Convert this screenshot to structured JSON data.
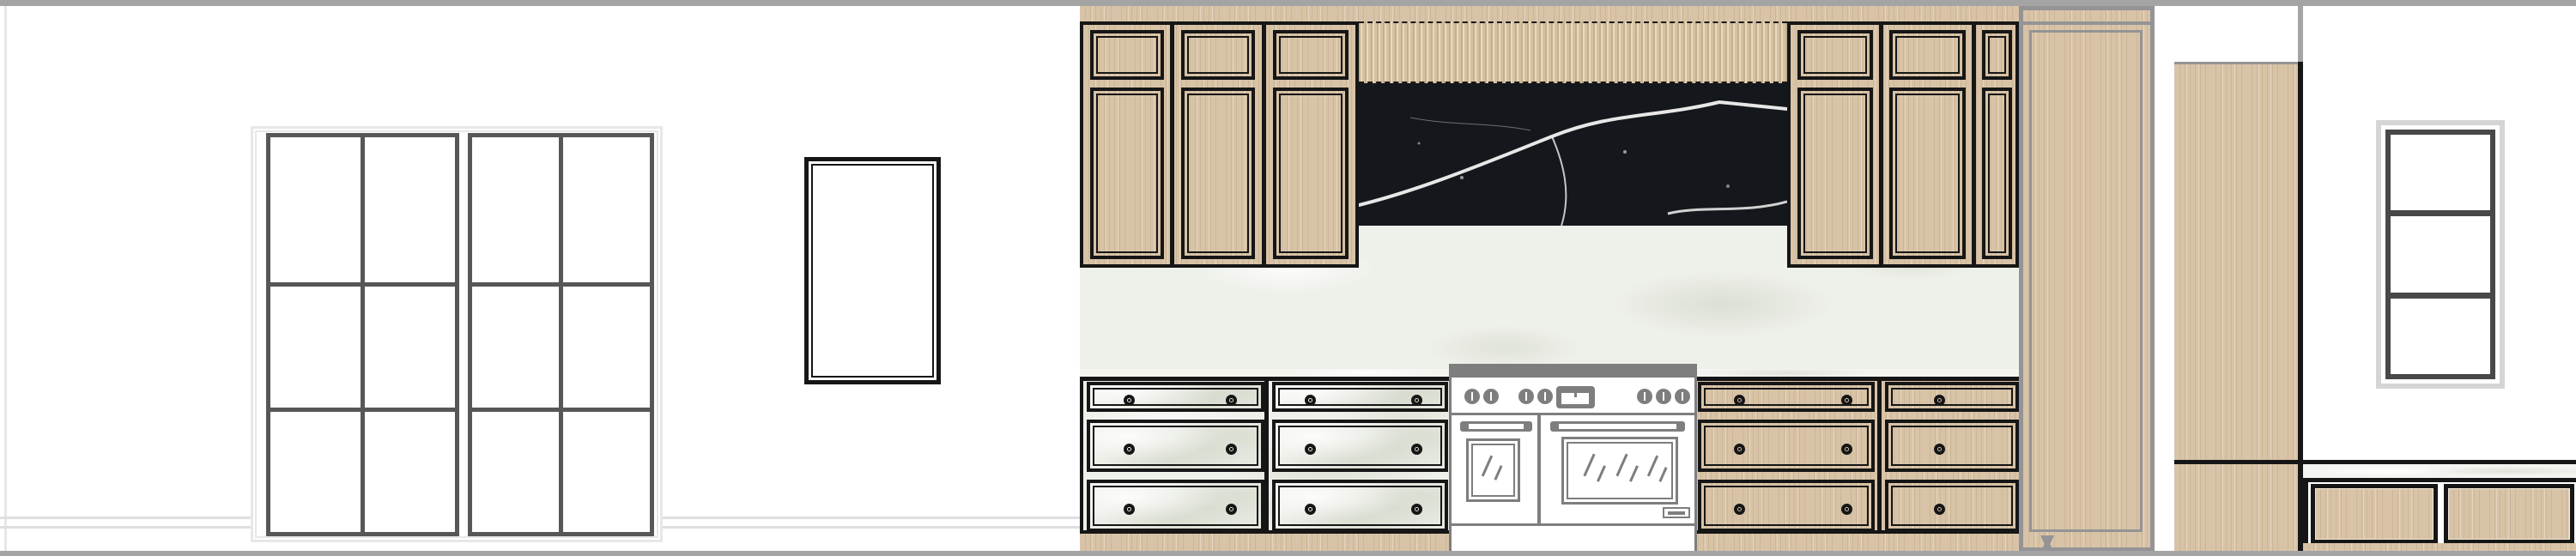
{
  "meta": {
    "kind": "interior-elevation-drawing",
    "description": "Kitchen wall elevation: french patio doors, framed wall opening, oak upper cabinets with fluted slat panel, black marble backsplash, white marble counter and drawer fronts, double-oven range, tall oak panel, end panel, window and window-seat bench"
  },
  "palette": {
    "wall": "#ffffff",
    "band": "#a4a4a4",
    "wood": "#d8c3a6",
    "woodGrain": "rgba(146,114,78,0.16)",
    "blackMarble": "#14171b",
    "vein": "#f2f2f2",
    "whiteMarble": "#eef0ea",
    "counterMarble": "#f4f5f1",
    "frame": "#161616",
    "rangeGray": "#7e7e7e",
    "doorFrame": "#575757",
    "casing": "#e7e7e7",
    "baseboard": "#dfdfdf",
    "panelGray": "#949496",
    "windowDark": "#484848",
    "windowLight": "#d5d5d5"
  },
  "left_wall": {
    "french_doors": {
      "leaves": 2,
      "panes_per_leaf": {
        "columns": 2,
        "rows": 3
      }
    },
    "framed_opening": {
      "shape": "rectangle",
      "frame": "double black line"
    },
    "baseboard_lines": 2
  },
  "kitchen": {
    "soffit": "oak strip",
    "upper_cabinets_left": {
      "doors": 3,
      "panels_per_door": 2
    },
    "upper_cabinets_right": {
      "doors": 3,
      "panels_per_door": 2
    },
    "slat_panel": {
      "material": "fluted oak",
      "position": "above backsplash"
    },
    "backsplash": {
      "material": "black marble with white veins"
    },
    "counter_backsplash": {
      "material": "white marble"
    },
    "countertop": {
      "material": "white marble slab"
    },
    "base_cabinet_left": {
      "columns": 2,
      "rows": 3,
      "front": "white marble",
      "knobs_per_drawer": 2
    },
    "base_cabinet_right": {
      "columns": 2,
      "rows": 3,
      "front": "oak",
      "knobs_col1": 2,
      "knobs_col2": 1
    },
    "range": {
      "knob_groups": [
        2,
        2,
        3
      ],
      "knobs_total": 7,
      "display": 1,
      "ovens": 2,
      "style": "gray line art"
    },
    "tall_panel": {
      "material": "oak",
      "outline": "gray"
    },
    "toe_kick": "oak"
  },
  "right_area": {
    "end_panel": {
      "material": "oak",
      "edge": "black line"
    },
    "window": {
      "panes": 3,
      "orientation": "stacked horizontal"
    },
    "bench": {
      "top": "white marble",
      "front_panels": 2,
      "front_material": "oak",
      "toe_kick": "oak"
    }
  }
}
